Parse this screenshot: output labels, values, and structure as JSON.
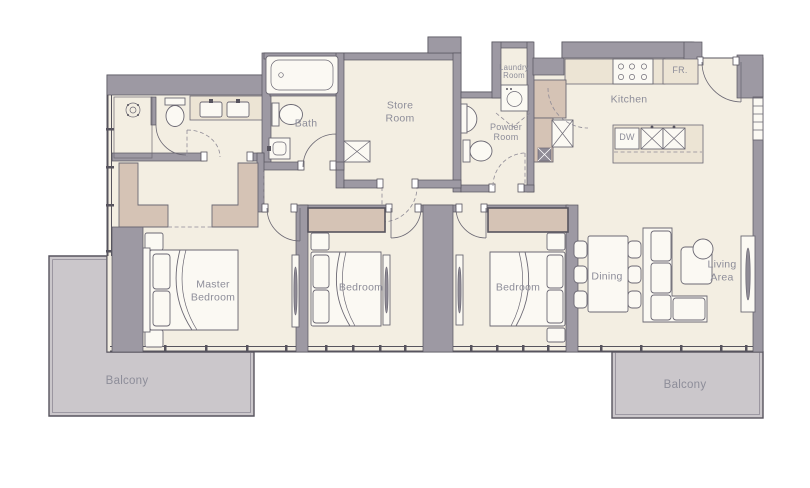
{
  "plan_title": "Apartment Floor Plan",
  "colors": {
    "floor": "#f3eee2",
    "wall": "#9d99a3",
    "wall_line": "#57545e",
    "line": "#6b6873",
    "line_soft": "#8f8b96",
    "tan": "#d5c3b5",
    "counter": "#ece4d4",
    "balcony": "#cbc7cb",
    "fixture": "#fbf9f3",
    "label_text": "#8d8d99"
  },
  "rooms": {
    "bath": {
      "label": "Bath"
    },
    "store": {
      "label": "Store\nRoom"
    },
    "laundry": {
      "label": "Laundry\nRoom"
    },
    "powder": {
      "label": "Powder\nRoom"
    },
    "kitchen": {
      "label": "Kitchen"
    },
    "master_bedroom": {
      "label": "Master\nBedroom"
    },
    "bedroom_2": {
      "label": "Bedroom"
    },
    "bedroom_3": {
      "label": "Bedroom"
    },
    "dining": {
      "label": "Dining"
    },
    "living_area": {
      "label": "Living\nArea"
    },
    "balcony_left": {
      "label": "Balcony"
    },
    "balcony_right": {
      "label": "Balcony"
    }
  },
  "appliances": {
    "fridge_label": "FR.",
    "dishwasher_label": "DW"
  },
  "fixtures": [
    "bathtub-icon",
    "shower-icon",
    "toilet-icon",
    "vanity-sink-icon",
    "washing-machine-icon",
    "stove-icon",
    "refrigerator-icon",
    "kitchen-island-icon",
    "double-sink-icon",
    "bed-icon",
    "wardrobe-icon",
    "mirror-icon",
    "dining-table-icon",
    "sofa-icon",
    "coffee-table-icon",
    "tv-console-icon",
    "window-icon",
    "door-swing-icon"
  ]
}
